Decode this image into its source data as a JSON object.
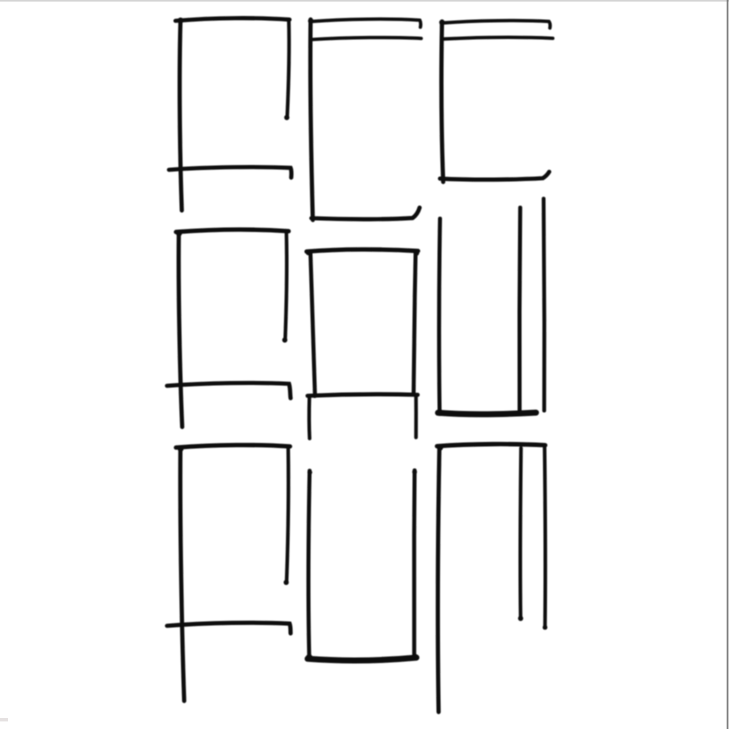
{
  "artwork": {
    "kind": "hand-drawn rectilinear ink lettering on white paper",
    "words": [
      "FEE",
      "FAW",
      "FUM"
    ],
    "background_color": "#ffffff",
    "ink_color": "#101010",
    "top_edge_color": "#c2c2c2",
    "right_edge_color": "#6e6e6e",
    "smudge_color": "#cfc9c9"
  },
  "edges": {
    "top_line": {
      "x": 0,
      "y": 0,
      "w": 729,
      "h": 1.6,
      "opacity": 0.7
    },
    "right_line": {
      "x": 726.7,
      "y": 0,
      "w": 1.7,
      "h": 729,
      "opacity": 0.9
    },
    "bottom_left_smudge": {
      "x": 0,
      "y": 718,
      "w": 8,
      "h": 3.4,
      "opacity": 0.55
    }
  },
  "glyphs": [
    {
      "id": "f-row1",
      "letter": "F",
      "word": "FEE",
      "row": 1,
      "col": 1,
      "strokes": [
        {
          "d": "M180.5,20 C179.2,65 179.3,140 181.8,210.5",
          "w": 4.2
        },
        {
          "d": "M175.5,20.8 C214,17.6 257,17.4 289.5,19.6",
          "w": 4.2
        },
        {
          "d": "M288.8,20 C289.6,52 288.4,90 287.2,116.5",
          "w": 3.6
        },
        {
          "d": "M169,169.8 C208,166.8 261,166.4 290.6,167.9 C291.8,170.8 291.4,174.4 291.2,177.6",
          "w": 4.2
        }
      ],
      "dots": [
        {
          "x": 286.8,
          "y": 117.5,
          "r": 2.6
        },
        {
          "x": 180.5,
          "y": 20.5,
          "r": 3.0
        }
      ]
    },
    {
      "id": "e1-row1",
      "letter": "E",
      "word": "FEE",
      "row": 1,
      "col": 2,
      "strokes": [
        {
          "d": "M310.6,19.5 C309.8,85 311.2,160 312.8,220",
          "w": 4.2
        },
        {
          "d": "M310.2,21.6 C346,18.8 392,18.4 419.8,20.2 C420.9,22.2 420.9,24.6 420.4,27.2",
          "w": 3.4
        },
        {
          "d": "M311,39.6 C346,37.4 396,36.9 421.2,38.4",
          "w": 3.4
        },
        {
          "d": "M311.4,218.2 C352,219.8 392,219.4 412.6,218 C416.2,215.4 418.4,211.6 419.6,207.6",
          "w": 4.2
        }
      ],
      "dots": [
        {
          "x": 310.8,
          "y": 21.0,
          "r": 2.8
        }
      ]
    },
    {
      "id": "e2-row1",
      "letter": "E",
      "word": "FEE",
      "row": 1,
      "col": 3,
      "strokes": [
        {
          "d": "M442,21.5 C441,75 441.4,135 443.2,182",
          "w": 4.2
        },
        {
          "d": "M441.8,23 C476,20.4 522,19.9 548.9,21.4 C550.3,23.2 550.4,25.4 549.9,28",
          "w": 3.4
        },
        {
          "d": "M442.8,39 C480,37.2 521,36.8 552.8,38.3",
          "w": 3.4
        },
        {
          "d": "M440,178.6 C474,180.2 516,179.8 542.8,178.2 C545.4,176.6 547.6,174.4 549.2,171.8",
          "w": 4.2
        }
      ],
      "dots": [
        {
          "x": 442.0,
          "y": 22.4,
          "r": 2.8
        }
      ]
    },
    {
      "id": "f-row2",
      "letter": "F",
      "word": "FAW",
      "row": 2,
      "col": 1,
      "strokes": [
        {
          "d": "M176,232 C216,229 257,229 288.6,231.2",
          "w": 4.4
        },
        {
          "d": "M178.8,233 C178.2,292 179.8,372 182.2,427",
          "w": 4.2
        },
        {
          "d": "M286.4,232.6 C287.2,266 286.2,312 285.2,339",
          "w": 3.6
        },
        {
          "d": "M167,385.8 C206,382.8 257,382.2 289,383.8 C290.4,388 290,393.8 290.6,398.2",
          "w": 4.2
        }
      ],
      "dots": [
        {
          "x": 284.8,
          "y": 340,
          "r": 2.6
        },
        {
          "x": 179.0,
          "y": 233.4,
          "r": 3.0
        }
      ]
    },
    {
      "id": "a-row2",
      "letter": "A",
      "word": "FAW",
      "row": 2,
      "col": 2,
      "strokes": [
        {
          "d": "M306.6,251.6 C340,248.8 382,248.8 418,251",
          "w": 4.4
        },
        {
          "d": "M310.4,251.4 C312,300 313.6,352 315,396",
          "w": 4.0
        },
        {
          "d": "M415.6,252.4 C414.6,300 414,350 413.6,394.4",
          "w": 4.0
        },
        {
          "d": "M307.6,395.8 C342,394.2 382,393.8 417.6,394.8",
          "w": 4.2
        },
        {
          "d": "M309.4,396.8 C309,412 309,426 309.6,438.4",
          "w": 3.6
        },
        {
          "d": "M416,396.4 C416.1,410 416.1,424 416,437.4",
          "w": 3.6
        }
      ],
      "dots": [
        {
          "x": 308.6,
          "y": 252.4,
          "r": 3.0
        },
        {
          "x": 416.4,
          "y": 253.0,
          "r": 2.8
        }
      ]
    },
    {
      "id": "w-row2",
      "letter": "W",
      "word": "FAW",
      "row": 2,
      "col": 3,
      "strokes": [
        {
          "d": "M440,218.6 C439,280 438.8,352 439.6,412",
          "w": 4.0
        },
        {
          "d": "M520.2,207.6 C519.6,268 519.2,352 519.6,413",
          "w": 4.0
        },
        {
          "d": "M543.6,198.6 C544.2,262 544.6,342 544.2,410.6",
          "w": 3.8
        },
        {
          "d": "M438,412.8 C466,415 504,414.4 536,412.6",
          "w": 6.0
        }
      ],
      "dots": [
        {
          "x": 440.0,
          "y": 412.6,
          "r": 3.4
        },
        {
          "x": 519.8,
          "y": 413.0,
          "r": 3.0
        }
      ]
    },
    {
      "id": "f-row3",
      "letter": "F",
      "word": "FUM",
      "row": 3,
      "col": 1,
      "strokes": [
        {
          "d": "M176,447.6 C216,444.4 259,444.4 290,446.4",
          "w": 4.4
        },
        {
          "d": "M180.4,448.4 C179.8,525 181.8,632 184.2,701",
          "w": 4.2
        },
        {
          "d": "M288.2,448.4 C288.8,492 287.8,548 286.6,581.4",
          "w": 3.6
        },
        {
          "d": "M167,625.8 C207,622.6 259,622 289.6,623.6 C290.8,627 290.4,630.4 290.6,633.4",
          "w": 4.2
        }
      ],
      "dots": [
        {
          "x": 286.2,
          "y": 582.4,
          "r": 2.6
        },
        {
          "x": 180.6,
          "y": 448.8,
          "r": 3.0
        }
      ]
    },
    {
      "id": "u-row3",
      "letter": "U",
      "word": "FUM",
      "row": 3,
      "col": 2,
      "strokes": [
        {
          "d": "M309.6,470.8 C308.4,532 308,602 309.2,656",
          "w": 4.0
        },
        {
          "d": "M414.6,470.4 C414,532 413.9,602 414.2,656",
          "w": 4.0
        },
        {
          "d": "M307.6,658.8 C342,661.4 382,660.8 416.4,657.6",
          "w": 6.0
        }
      ],
      "dots": [
        {
          "x": 309.2,
          "y": 657.8,
          "r": 3.6
        },
        {
          "x": 415.0,
          "y": 657.0,
          "r": 3.2
        },
        {
          "x": 309.8,
          "y": 472.4,
          "r": 2.4
        },
        {
          "x": 414.6,
          "y": 472.0,
          "r": 2.4
        }
      ]
    },
    {
      "id": "m-row3",
      "letter": "M",
      "word": "FUM",
      "row": 3,
      "col": 3,
      "strokes": [
        {
          "d": "M437,446.2 C471,443.6 516,443.6 545.2,445.2",
          "w": 4.4
        },
        {
          "d": "M439.4,446.6 C437.8,535 437.4,635 438.6,712",
          "w": 4.2
        },
        {
          "d": "M521,448.2 C520.4,502 520,572 520.6,617.4",
          "w": 3.6
        },
        {
          "d": "M544.6,447.2 C545.2,502 545.6,574 545,626.4",
          "w": 3.6
        }
      ],
      "dots": [
        {
          "x": 520.6,
          "y": 618.4,
          "r": 2.6
        },
        {
          "x": 545.0,
          "y": 627.4,
          "r": 2.4
        },
        {
          "x": 440.0,
          "y": 447.4,
          "r": 3.2
        }
      ]
    }
  ]
}
